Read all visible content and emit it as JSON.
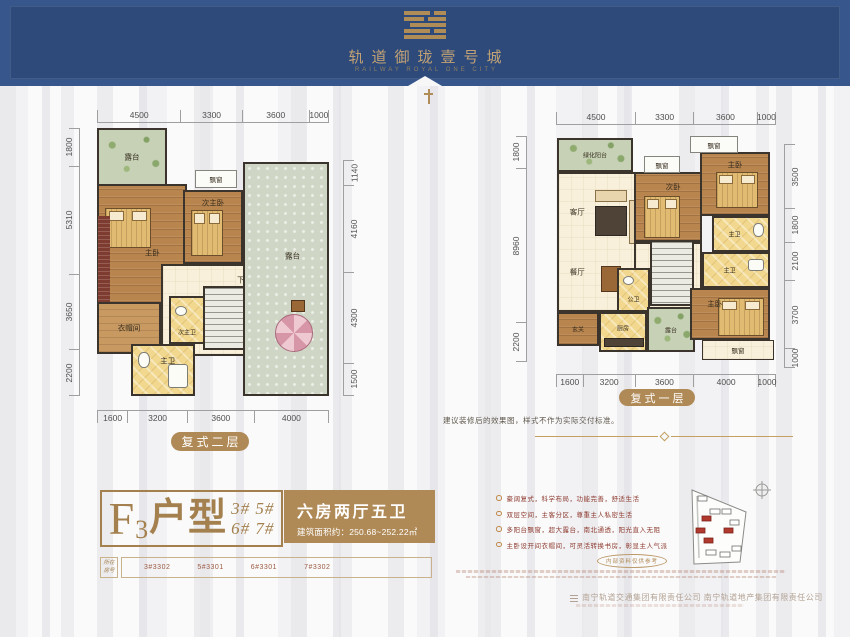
{
  "header": {
    "title": "轨道御珑壹号城",
    "subtitle": "RAILWAY ROYAL ONE CITY"
  },
  "plans": {
    "left": {
      "label": "复式二层",
      "dims_top": [
        "4500",
        "3300",
        "3600",
        "1000"
      ],
      "dims_bottom": [
        "1600",
        "3200",
        "3600",
        "4000"
      ],
      "dims_left": [
        "1800",
        "5310",
        "3650",
        "2200"
      ],
      "dims_right": [
        "1140",
        "4160",
        "4300",
        "1500"
      ],
      "rooms": {
        "terrace_top": "露台",
        "master": "主卧",
        "sec_master": "次主卧",
        "bay_window": "飘窗",
        "cloakroom": "衣帽间",
        "sec_bath": "次主卫",
        "master_bath": "主卫",
        "stairs": "下",
        "terrace_right": "露台"
      }
    },
    "right": {
      "label": "复式一层",
      "dims_top": [
        "4500",
        "3300",
        "3600",
        "1000"
      ],
      "dims_bottom": [
        "1600",
        "3200",
        "3600",
        "4000",
        "1000"
      ],
      "dims_left": [
        "1800",
        "8960",
        "2200"
      ],
      "dims_right": [
        "3500",
        "1800",
        "2100",
        "3700",
        "1000"
      ],
      "rooms": {
        "green_balcony": "绿化阳台",
        "living": "客厅",
        "dining": "餐厅",
        "entry": "玄关",
        "kitchen": "厨房",
        "terrace": "露台",
        "public_bath": "公卫",
        "stairs": "上",
        "bedroom2": "次卧",
        "master_top": "主卧",
        "bath_top": "主卫",
        "bath_mid": "主卫",
        "master_bottom": "主卧",
        "bay_window_1": "飘窗",
        "bay_window_2": "飘窗",
        "bay_window_3": "飘窗"
      }
    }
  },
  "note": "建议装修后的效果图，样式不作为实际交付标准。",
  "unit_info": {
    "prefix": "F",
    "sub": "3",
    "suffix": "户型",
    "buildings_line1": "3# 5#",
    "buildings_line2": "6# 7#",
    "layout": "六房两厅五卫",
    "area": "建筑面积约：250.68~252.22㎡"
  },
  "room_numbers": {
    "label_line1": "所在",
    "label_line2": "房号",
    "values": [
      "3#3302",
      "5#3301",
      "6#3301",
      "7#3302"
    ]
  },
  "selling_points": [
    "豪阔复式，科学布局，功能完善，舒适生活",
    "双层空间，主客分区，尊重主人私密生活",
    "多阳台飘窗，超大露台，南北通透，阳光直入无阻",
    "主卧设开间衣帽间，可灵活转换书房，彰显主人气派"
  ],
  "stamp": "内部资料仅供参考",
  "footer": "南宁轨道交通集团有限责任公司 南宁轨道地产集团有限责任公司",
  "colors": {
    "brand_blue": "#2d4a7b",
    "gold": "#b08a56",
    "accent_red": "#8e3a2f"
  }
}
